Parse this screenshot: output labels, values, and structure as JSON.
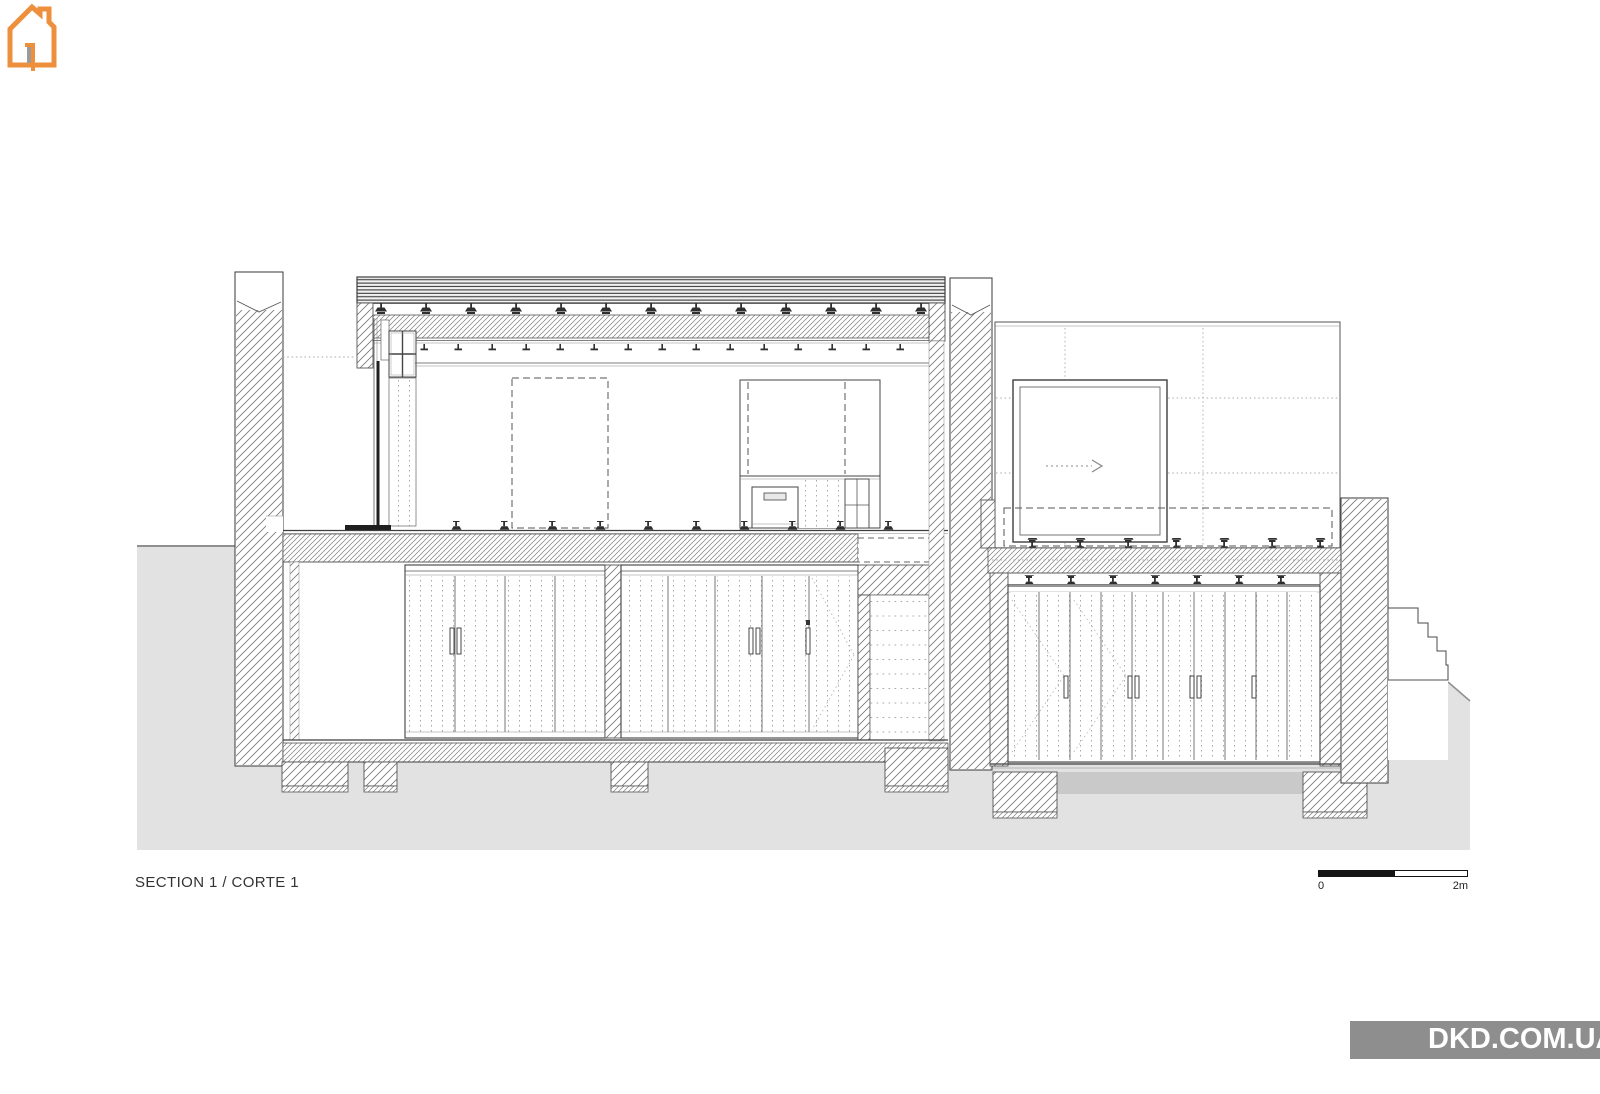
{
  "drawing": {
    "title": "SECTION 1 / CORTE 1",
    "kind": "architectural building cross-section with adjacent garage elevation",
    "scale_bar": {
      "zero_label": "0",
      "end_label": "2m"
    }
  },
  "watermark": {
    "text": "DKD.COM.UA",
    "house_color": "#ee8f3c",
    "banner_color": "#8e8e8e",
    "text_color": "#ffffff"
  },
  "colors": {
    "paper": "#ffffff",
    "ground_fill": "#e2e2e2",
    "slab_strip_fill": "#c9c9c9",
    "line_color": "#3f3f3f"
  }
}
